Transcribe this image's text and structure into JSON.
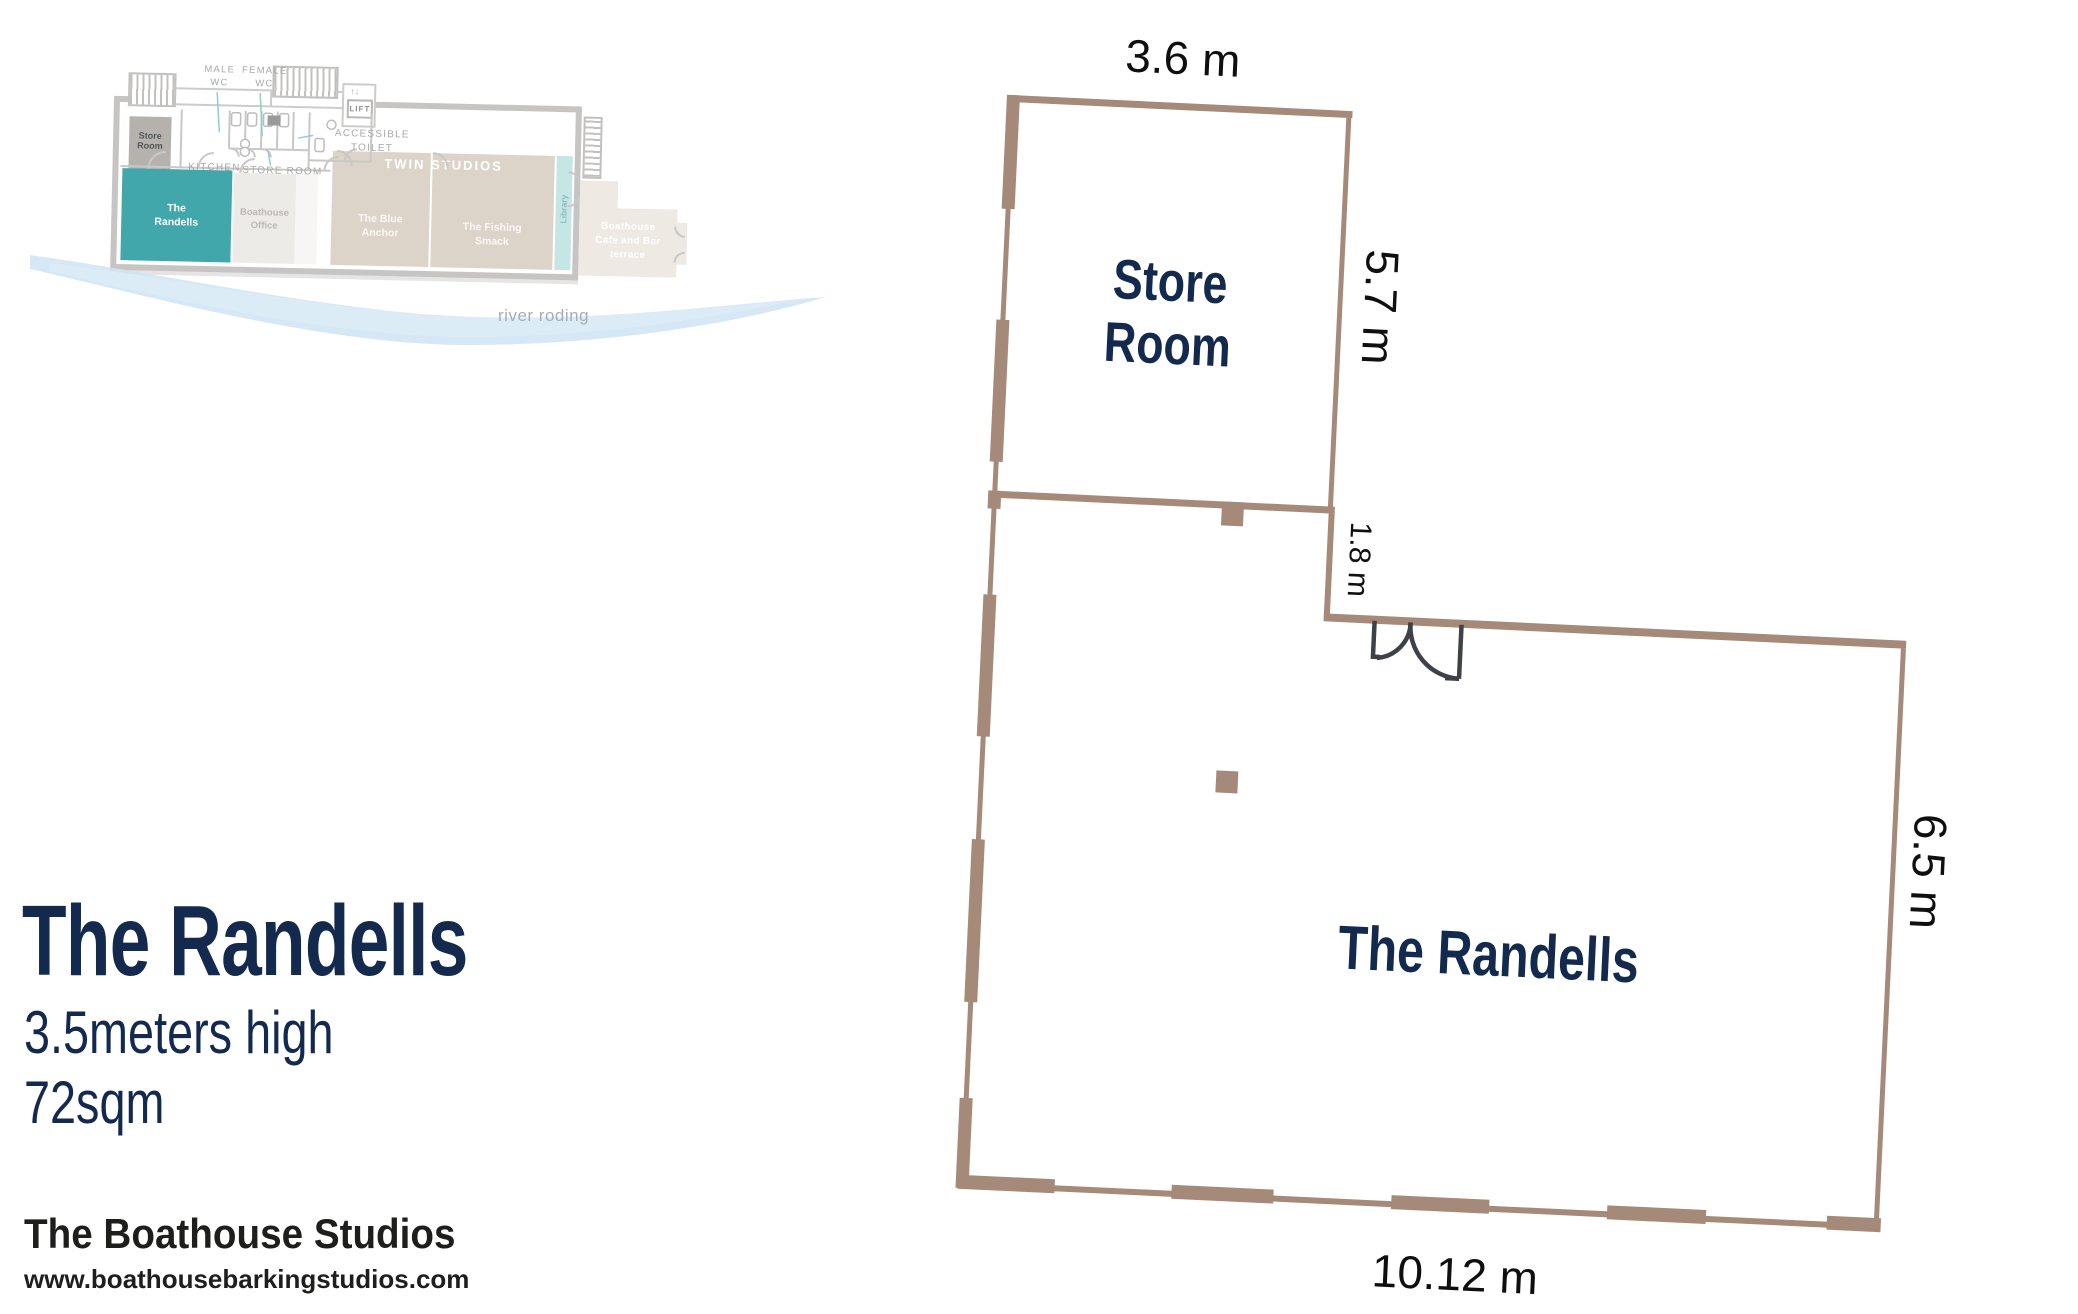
{
  "colors": {
    "wall_brown": "#a58a79",
    "navy": "#132a4e",
    "teal_room": "#41a7ab",
    "door_dark": "#3e4147",
    "map_wall_gray": "#c6c5c3",
    "river_blue": "#cfe4f5"
  },
  "info_panel": {
    "title": "The Randells",
    "height_line": "3.5meters high\n72sqm",
    "brand": "The Boathouse Studios",
    "website": "www.boathousebarkingstudios.com"
  },
  "overview_map": {
    "corridor_labels": {
      "male_wc": "MALE\nWC",
      "female_wc": "FEMALE\nWC",
      "accessible_toilet": "ACCESSIBLE\nTOILET",
      "lift": "LIFT",
      "kitchen": "KITCHEN",
      "store_room": "STORE ROOM"
    },
    "rooms": {
      "store_room": "Store\nRoom",
      "the_randells": "The\nRandells",
      "boathouse_office": "Boathouse\nOffice",
      "twin_studios": "TWIN STUDIOS",
      "blue_anchor": "The Blue\nAnchor",
      "fishing_smack": "The Fishing\nSmack",
      "library": "Library",
      "cafe_terrace": "Boathouse\nCafe and Bar\nterrace"
    },
    "river_label": "river roding"
  },
  "floor_plan": {
    "rooms": {
      "store_room": "Store\nRoom",
      "main_room": "The Randells"
    },
    "dimensions": {
      "store_width": "3.6 m",
      "store_height": "5.7 m",
      "connector": "1.8 m",
      "main_height": "6.5 m",
      "main_width": "10.12 m"
    }
  }
}
